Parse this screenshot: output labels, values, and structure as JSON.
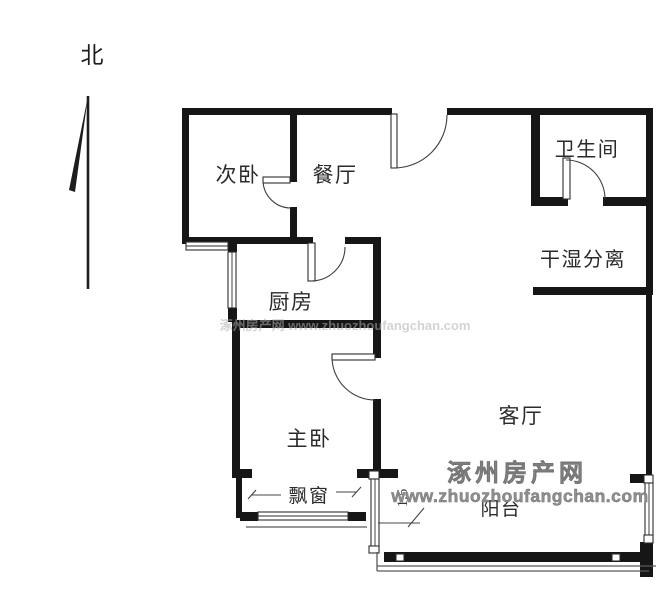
{
  "compass": {
    "label": "北"
  },
  "rooms": [
    {
      "id": "secondary-bedroom",
      "label": "次卧"
    },
    {
      "id": "dining-room",
      "label": "餐厅"
    },
    {
      "id": "bathroom",
      "label": "卫生间"
    },
    {
      "id": "dry-wet-separation",
      "label": "干湿分离"
    },
    {
      "id": "kitchen",
      "label": "厨房"
    },
    {
      "id": "master-bedroom",
      "label": "主卧"
    },
    {
      "id": "living-room",
      "label": "客厅"
    },
    {
      "id": "bay-window",
      "label": "飘窗"
    },
    {
      "id": "balcony",
      "label": "阳台"
    }
  ],
  "annotations": {
    "dimension": "1.5"
  },
  "watermark": {
    "site_name": "涿州房产网",
    "site_url": "www.zhuozhoufangchan.com",
    "faint_line": "涿州房产网 www.zhuozhoufangchan.com",
    "color": "#8f8f8f"
  },
  "colors": {
    "wall": "#161616",
    "background": "#ffffff",
    "line": "#3f3f3f"
  }
}
